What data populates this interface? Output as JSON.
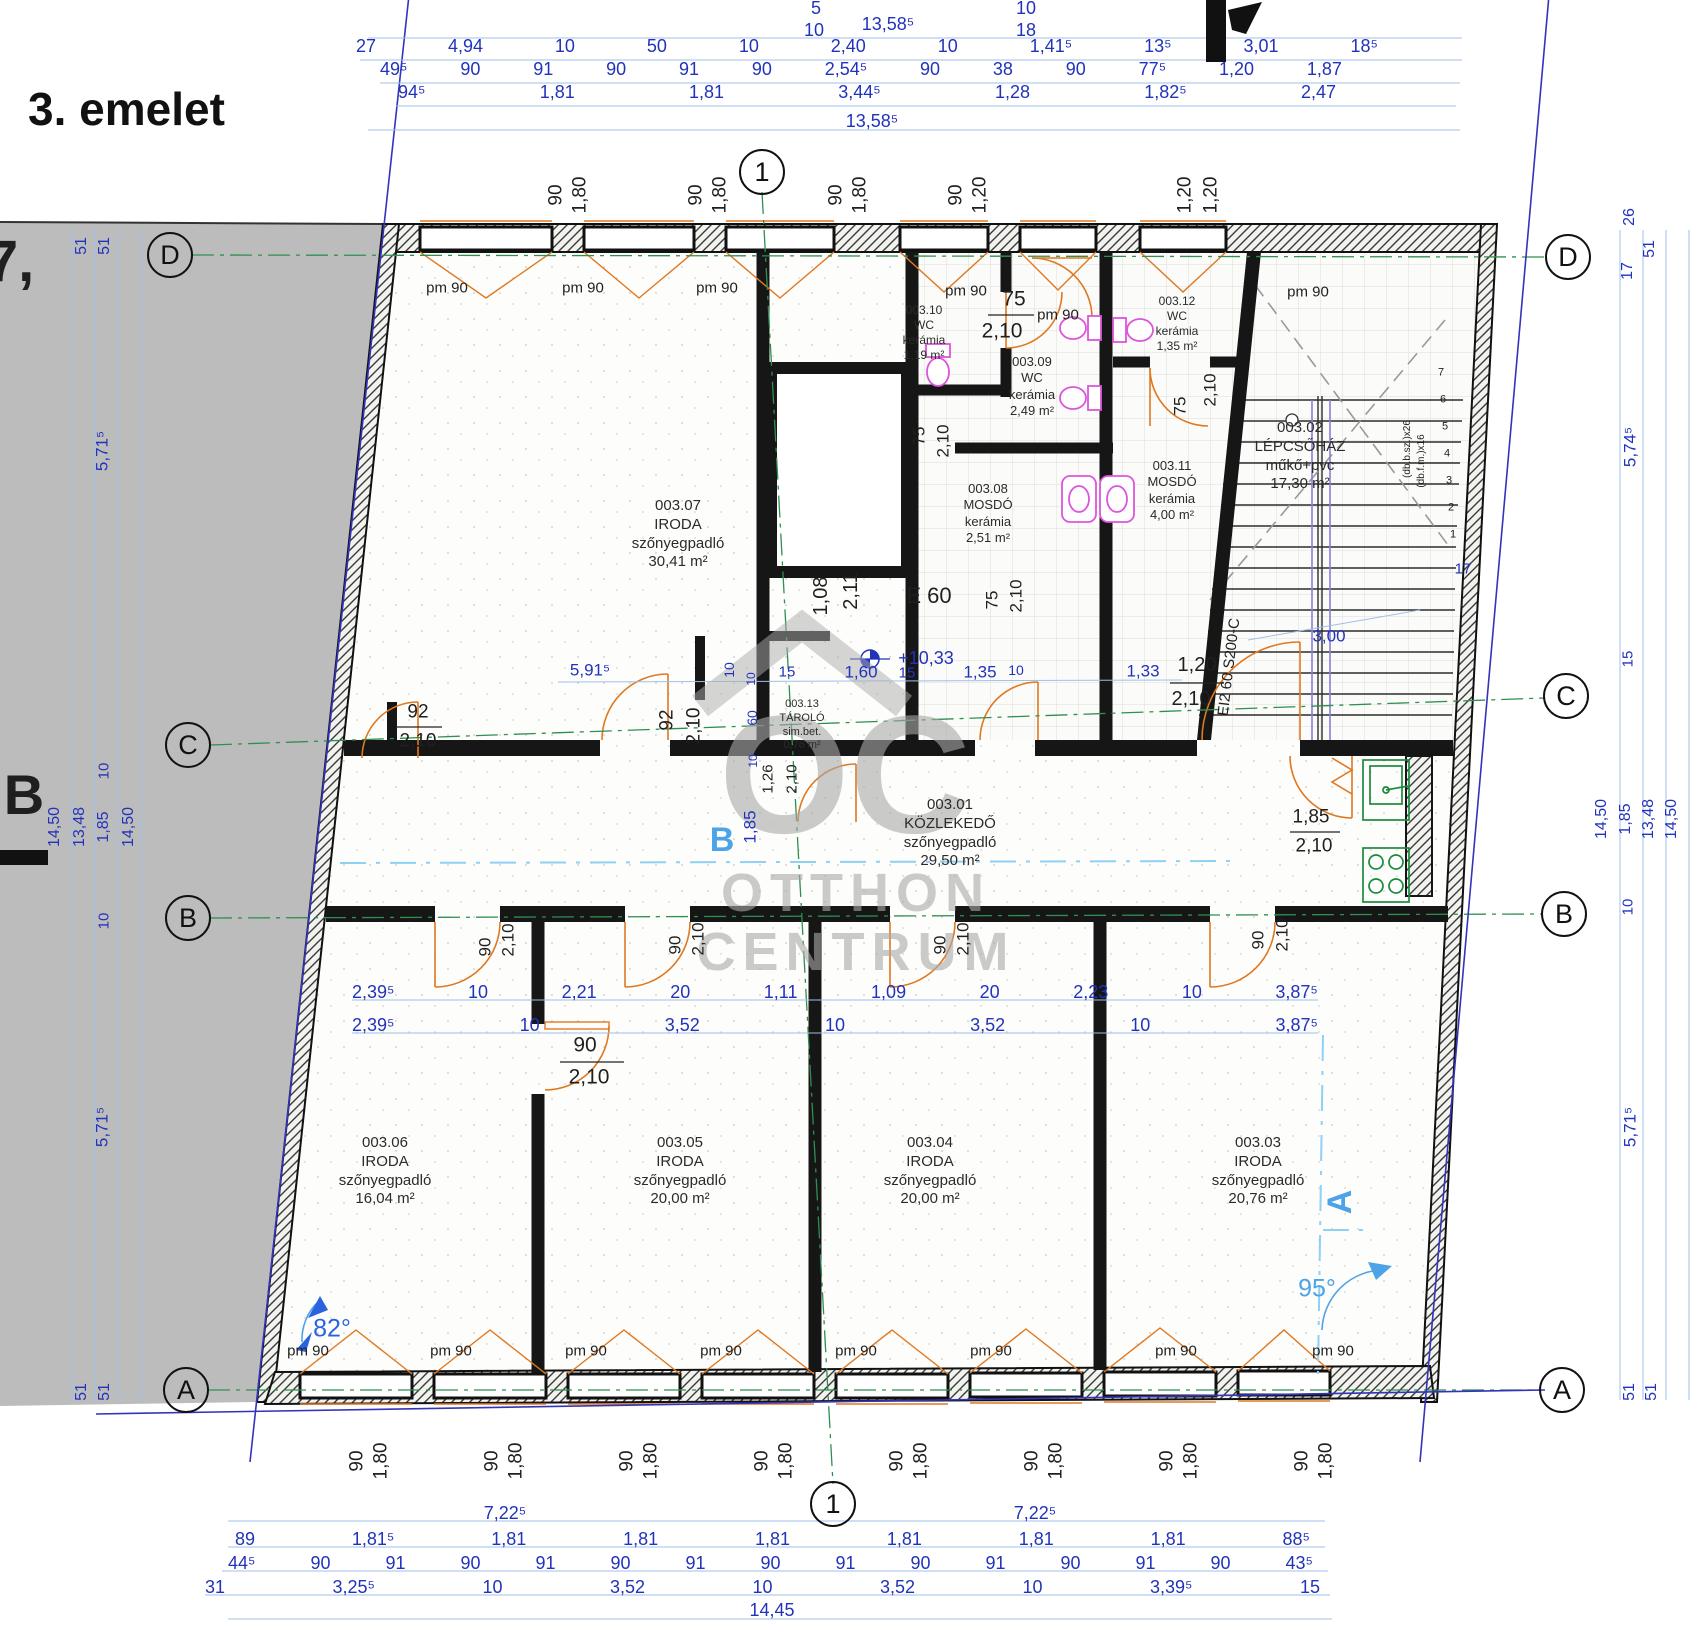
{
  "title": "3. emelet",
  "watermark": {
    "logo_text": "OC",
    "line1": "OTTHON",
    "line2": "CENTRUM"
  },
  "axes": {
    "col_top": "1",
    "col_bottom": "1",
    "rows_left": [
      "D",
      "C",
      "B",
      "A"
    ],
    "rows_right": [
      "D",
      "C",
      "B",
      "A"
    ]
  },
  "labels": {
    "pm90": "pm 90"
  },
  "elevation": "+10,33",
  "rooms": [
    {
      "id": "003.01",
      "name": "KÖZLEKEDŐ",
      "floor": "szőnyegpadló",
      "area": "29,50 m²"
    },
    {
      "id": "003.02",
      "name": "LÉPCSŐHÁZ",
      "floor": "műkő+pvc",
      "area": "17,30 m²"
    },
    {
      "id": "003.03",
      "name": "IRODA",
      "floor": "szőnyegpadló",
      "area": "20,76 m²"
    },
    {
      "id": "003.04",
      "name": "IRODA",
      "floor": "szőnyegpadló",
      "area": "20,00 m²"
    },
    {
      "id": "003.05",
      "name": "IRODA",
      "floor": "szőnyegpadló",
      "area": "20,00 m²"
    },
    {
      "id": "003.06",
      "name": "IRODA",
      "floor": "szőnyegpadló",
      "area": "16,04 m²"
    },
    {
      "id": "003.07",
      "name": "IRODA",
      "floor": "szőnyegpadló",
      "area": "30,41 m²"
    },
    {
      "id": "003.08",
      "name": "MOSDÓ",
      "floor": "kerámia",
      "area": "2,51 m²"
    },
    {
      "id": "003.09",
      "name": "WC",
      "floor": "kerámia",
      "area": "2,49 m²"
    },
    {
      "id": "003.10",
      "name": "WC",
      "floor": "kerámia",
      "area": "1,19 m²"
    },
    {
      "id": "003.11",
      "name": "MOSDÓ",
      "floor": "kerámia",
      "area": "4,00 m²"
    },
    {
      "id": "003.12",
      "name": "WC",
      "floor": "kerámia",
      "area": "1,35 m²"
    },
    {
      "id": "003.13",
      "name": "TÁROLÓ",
      "floor": "sim.bet.",
      "area": "0,76 m²"
    }
  ],
  "stair": {
    "steps": [
      "1",
      "2",
      "3",
      "4",
      "5",
      "6",
      "7"
    ],
    "note1": "(db.b.sz.)x26",
    "note2": "(db.f.m.)x16"
  },
  "chains": {
    "top_row1": [
      "27",
      "4,94",
      "10",
      "50",
      "10",
      "2,40",
      "10",
      "1,41⁵",
      "13⁵",
      "3,01",
      "18⁵"
    ],
    "top_row2": [
      "49⁵",
      "90",
      "91",
      "90",
      "91",
      "90",
      "2,54⁵",
      "90",
      "38",
      "90",
      "77⁵",
      "1,20",
      "1,87"
    ],
    "top_row3": [
      "94⁵",
      "1,81",
      "1,81",
      "3,44⁵",
      "1,28",
      "1,82⁵",
      "2,47"
    ],
    "bottom_row1": [
      "7,22⁵",
      "7,22⁵"
    ],
    "bottom_row2": [
      "89",
      "1,81⁵",
      "1,81",
      "1,81",
      "1,81",
      "1,81",
      "1,81",
      "1,81",
      "88⁵"
    ],
    "bottom_row3": [
      "44⁵",
      "90",
      "91",
      "90",
      "91",
      "90",
      "91",
      "90",
      "91",
      "90",
      "91",
      "90",
      "91",
      "90",
      "43⁵"
    ],
    "bottom_row4": [
      "31",
      "3,25⁵",
      "10",
      "3,52",
      "10",
      "3,52",
      "10",
      "3,39⁵",
      "15"
    ],
    "mid_b1": [
      "2,39⁵",
      "10",
      "2,21",
      "20",
      "1,11",
      "1,09",
      "20",
      "2,23",
      "10",
      "3,87⁵"
    ],
    "mid_b2": [
      "2,39⁵",
      "10",
      "3,52",
      "10",
      "3,52",
      "10",
      "3,87⁵"
    ]
  },
  "free_labels": [
    "5",
    "10",
    "13,58⁵",
    "10",
    "18",
    "13,58⁵",
    "14,45",
    "51",
    "51",
    "5,71⁵",
    "10",
    "14,50",
    "13,48",
    "1,85",
    "14,50",
    "10",
    "5,71⁵",
    "51",
    "51",
    "26",
    "51",
    "17",
    "5,74⁵",
    "15",
    "14,50",
    "1,85",
    "13,48",
    "14,50",
    "10",
    "5,71⁵",
    "51",
    "51",
    "90",
    "1,80",
    "90",
    "1,80",
    "90",
    "1,80",
    "90",
    "1,20",
    "1,20",
    "1,20",
    "5,91⁵",
    "10",
    "15",
    "1,60",
    "15",
    "1,35",
    "10",
    "1,33",
    "1,20",
    "2,10",
    "3,00",
    "17",
    "1,08",
    "2,11",
    "E 60",
    "+10,33",
    "10",
    "60",
    "10",
    "1,26",
    "2,10",
    "1,85",
    "92",
    "2,10",
    "92",
    "2,10",
    "75",
    "2,10",
    "75",
    "2,10",
    "75",
    "2,10",
    "75",
    "2,10",
    "1,85",
    "2,10",
    "90",
    "2,10",
    "90",
    "2,10",
    "90",
    "2,10",
    "90",
    "2,10",
    "90",
    "2,10",
    "EI2 60 S200-C",
    "B",
    "A",
    "82°",
    "95°",
    "B",
    "7,",
    "90",
    "1,80",
    "90",
    "1,80",
    "90",
    "1,80",
    "90",
    "1,80",
    "90",
    "1,80",
    "90",
    "1,80",
    "90",
    "1,80",
    "90",
    "1,80"
  ]
}
